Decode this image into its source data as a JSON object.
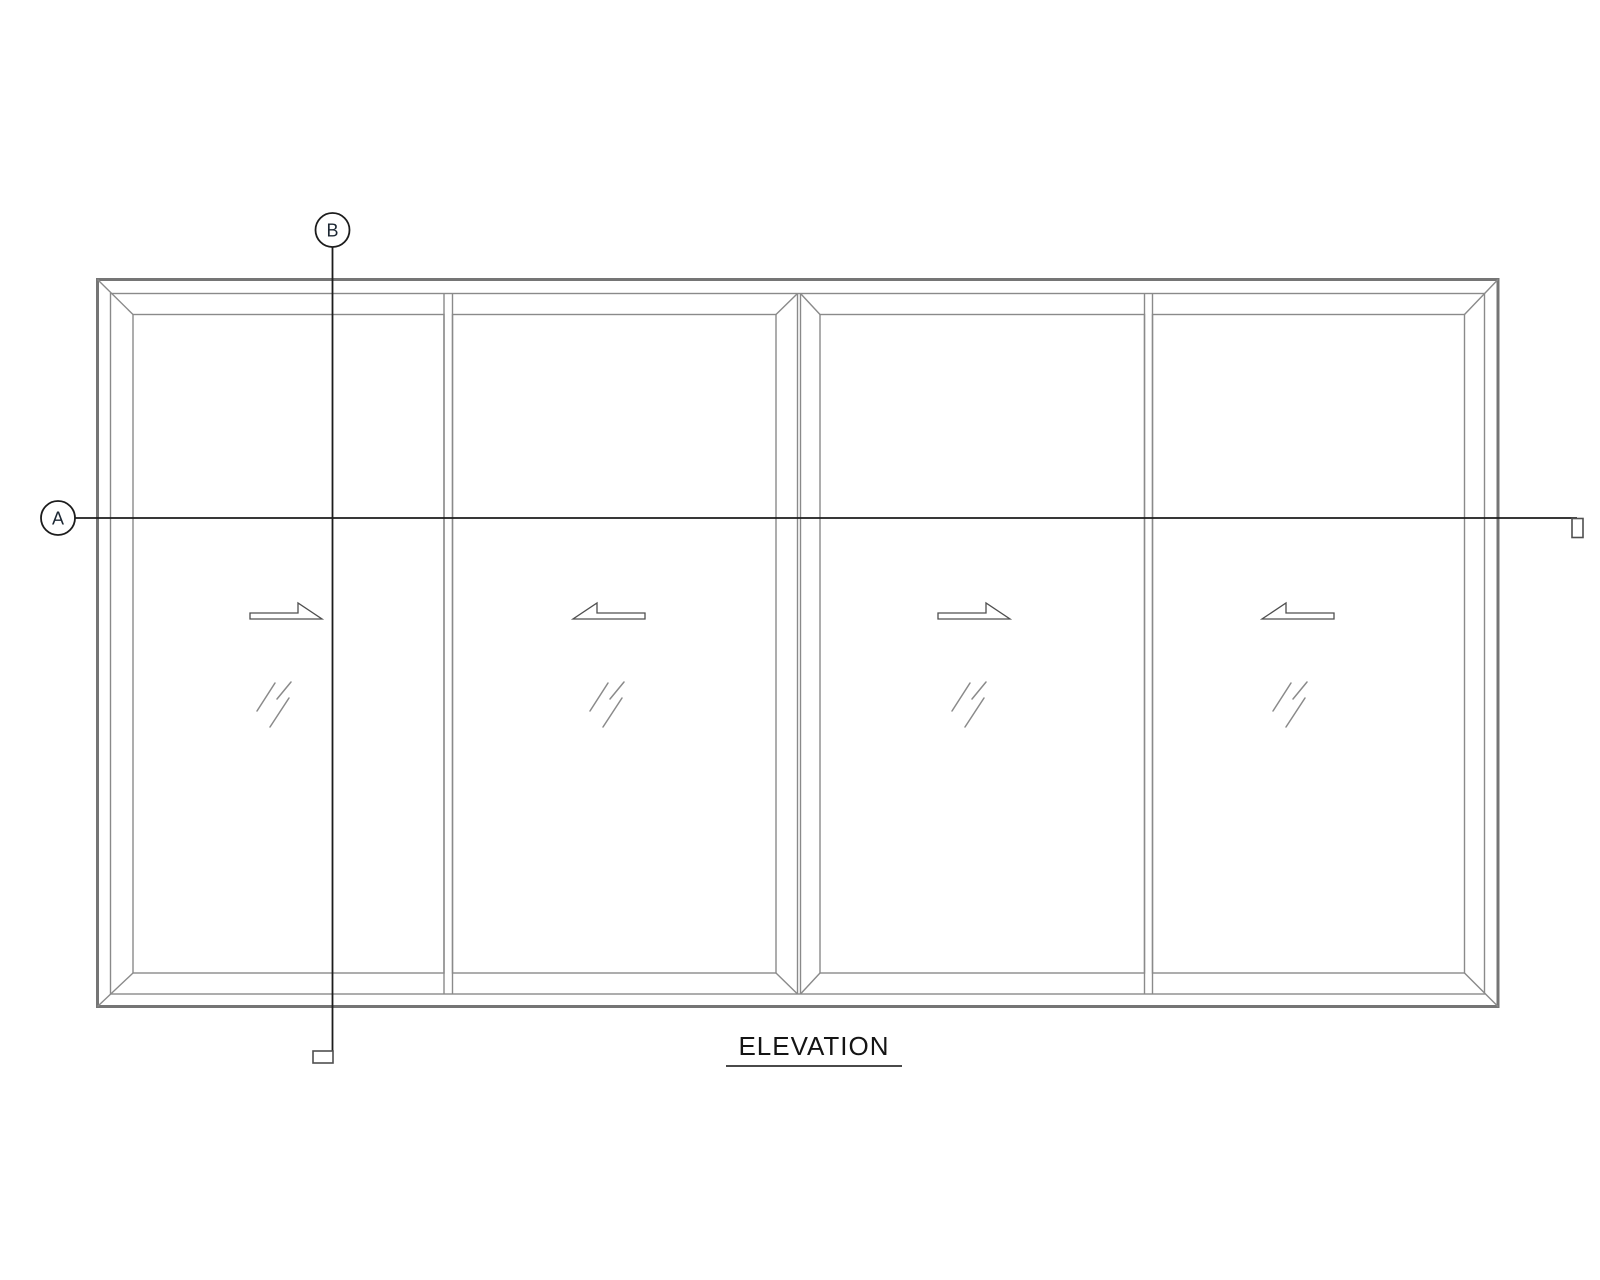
{
  "page": {
    "background_color": "#ffffff",
    "type": "cad-elevation-drawing"
  },
  "drawing": {
    "title": "ELEVATION",
    "section_markers": {
      "a": {
        "label": "A",
        "orientation": "horizontal"
      },
      "b": {
        "label": "B",
        "orientation": "vertical"
      }
    },
    "panels": [
      {
        "name": "panel-1",
        "slide_direction": "right",
        "glazing": "glass"
      },
      {
        "name": "panel-2",
        "slide_direction": "left",
        "glazing": "glass"
      },
      {
        "name": "panel-3",
        "slide_direction": "right",
        "glazing": "glass"
      },
      {
        "name": "panel-4",
        "slide_direction": "left",
        "glazing": "glass"
      }
    ],
    "colors": {
      "frame_line": "#757575",
      "sash_line": "#8a8a8a",
      "section_line": "#1c1c1c",
      "annotation_line": "#4f4f4f",
      "title_text": "#141414"
    }
  }
}
